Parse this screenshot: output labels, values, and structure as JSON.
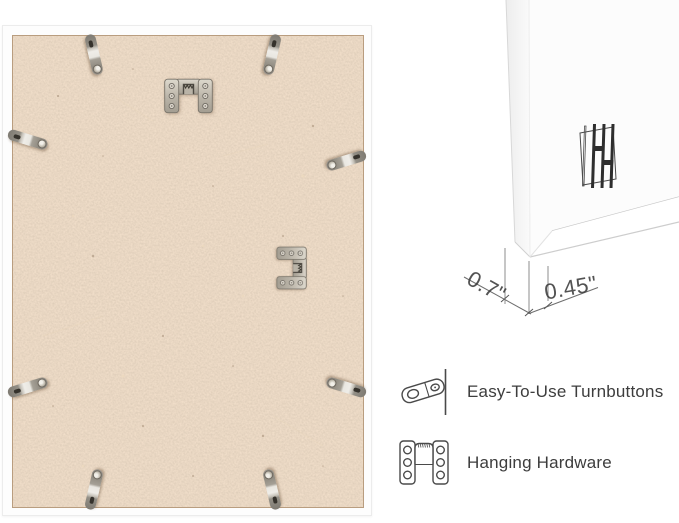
{
  "product_view": {
    "description": "rear view of white picture frame with MDF backing",
    "frame_color": "#ffffff",
    "backing_color": "#cbaa8b",
    "metal_color": "#b3ada1",
    "turnbutton_count": 8,
    "hanger_count": 2
  },
  "corner_detail": {
    "depth_label": "0.7\"",
    "face_label": "0.45\"",
    "line_color": "#8c8c8c",
    "text_color": "#3c3c3c"
  },
  "legend": {
    "items": [
      {
        "icon": "turnbutton-icon",
        "label": "Easy-To-Use Turnbuttons"
      },
      {
        "icon": "hanging-hardware-icon",
        "label": "Hanging Hardware"
      }
    ],
    "text_color": "#3d3d3d",
    "line_art_color": "#4a4a4a"
  }
}
